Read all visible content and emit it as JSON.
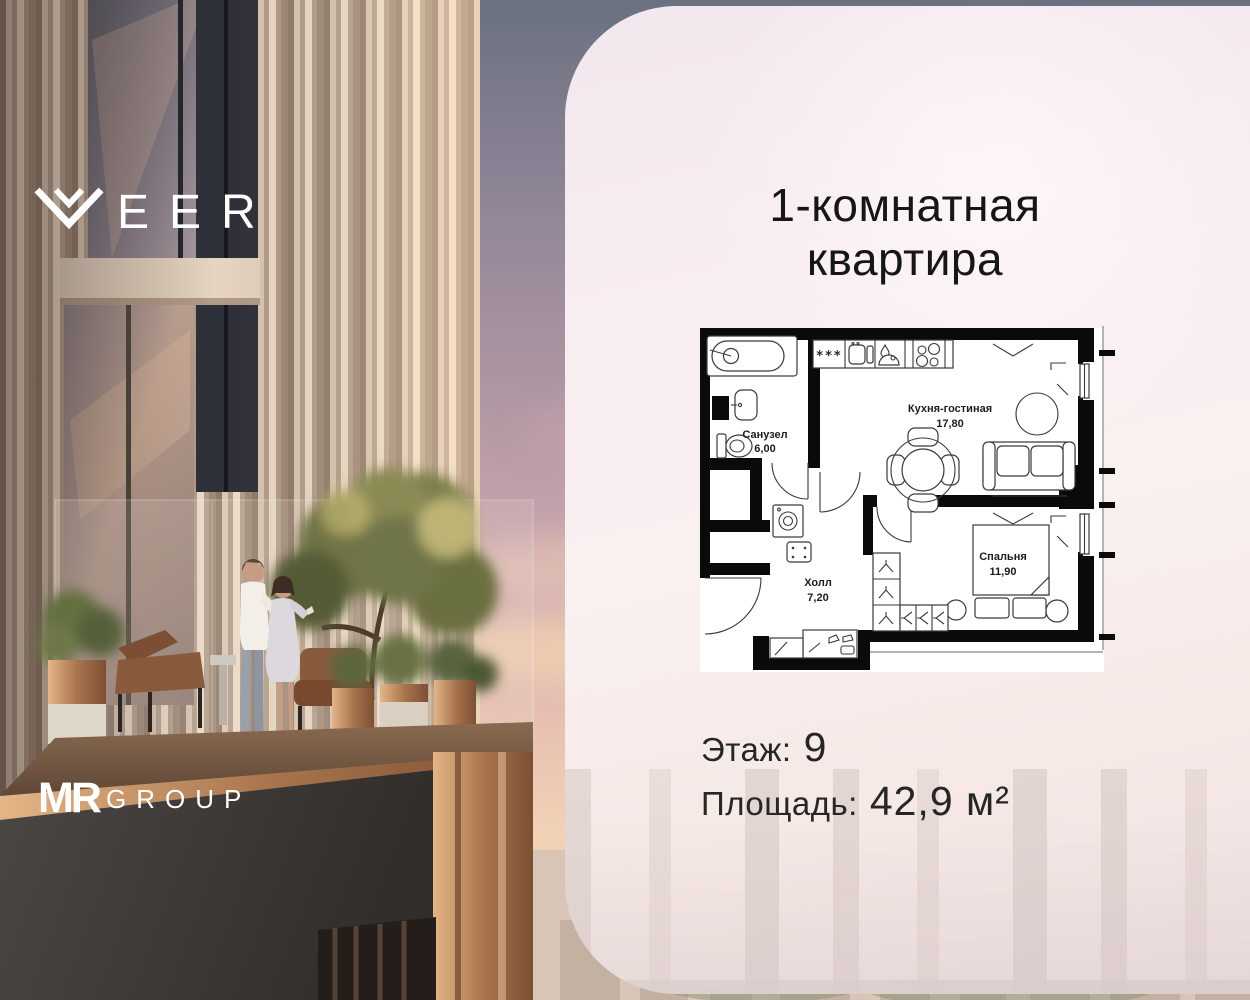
{
  "branding": {
    "project_logo_letters": "EER",
    "developer_logo_mr": "MR",
    "developer_logo_group": "GROUP"
  },
  "card": {
    "title_line1": "1-комнатная",
    "title_line2": "квартира",
    "floor_label": "Этаж:",
    "floor_value": "9",
    "area_label": "Площадь:",
    "area_value": "42,9 м²"
  },
  "floor_plan": {
    "rooms": [
      {
        "name": "Санузел",
        "area": "6,00"
      },
      {
        "name": "Кухня-гостиная",
        "area": "17,80"
      },
      {
        "name": "Холл",
        "area": "7,20"
      },
      {
        "name": "Спальня",
        "area": "11,90"
      }
    ],
    "fridge_symbol": "***"
  },
  "colors": {
    "card_bg": "#f7ecef",
    "wall": "#0a0a0a",
    "text_primary": "#1c1c1c",
    "logo_white": "#ffffff"
  }
}
